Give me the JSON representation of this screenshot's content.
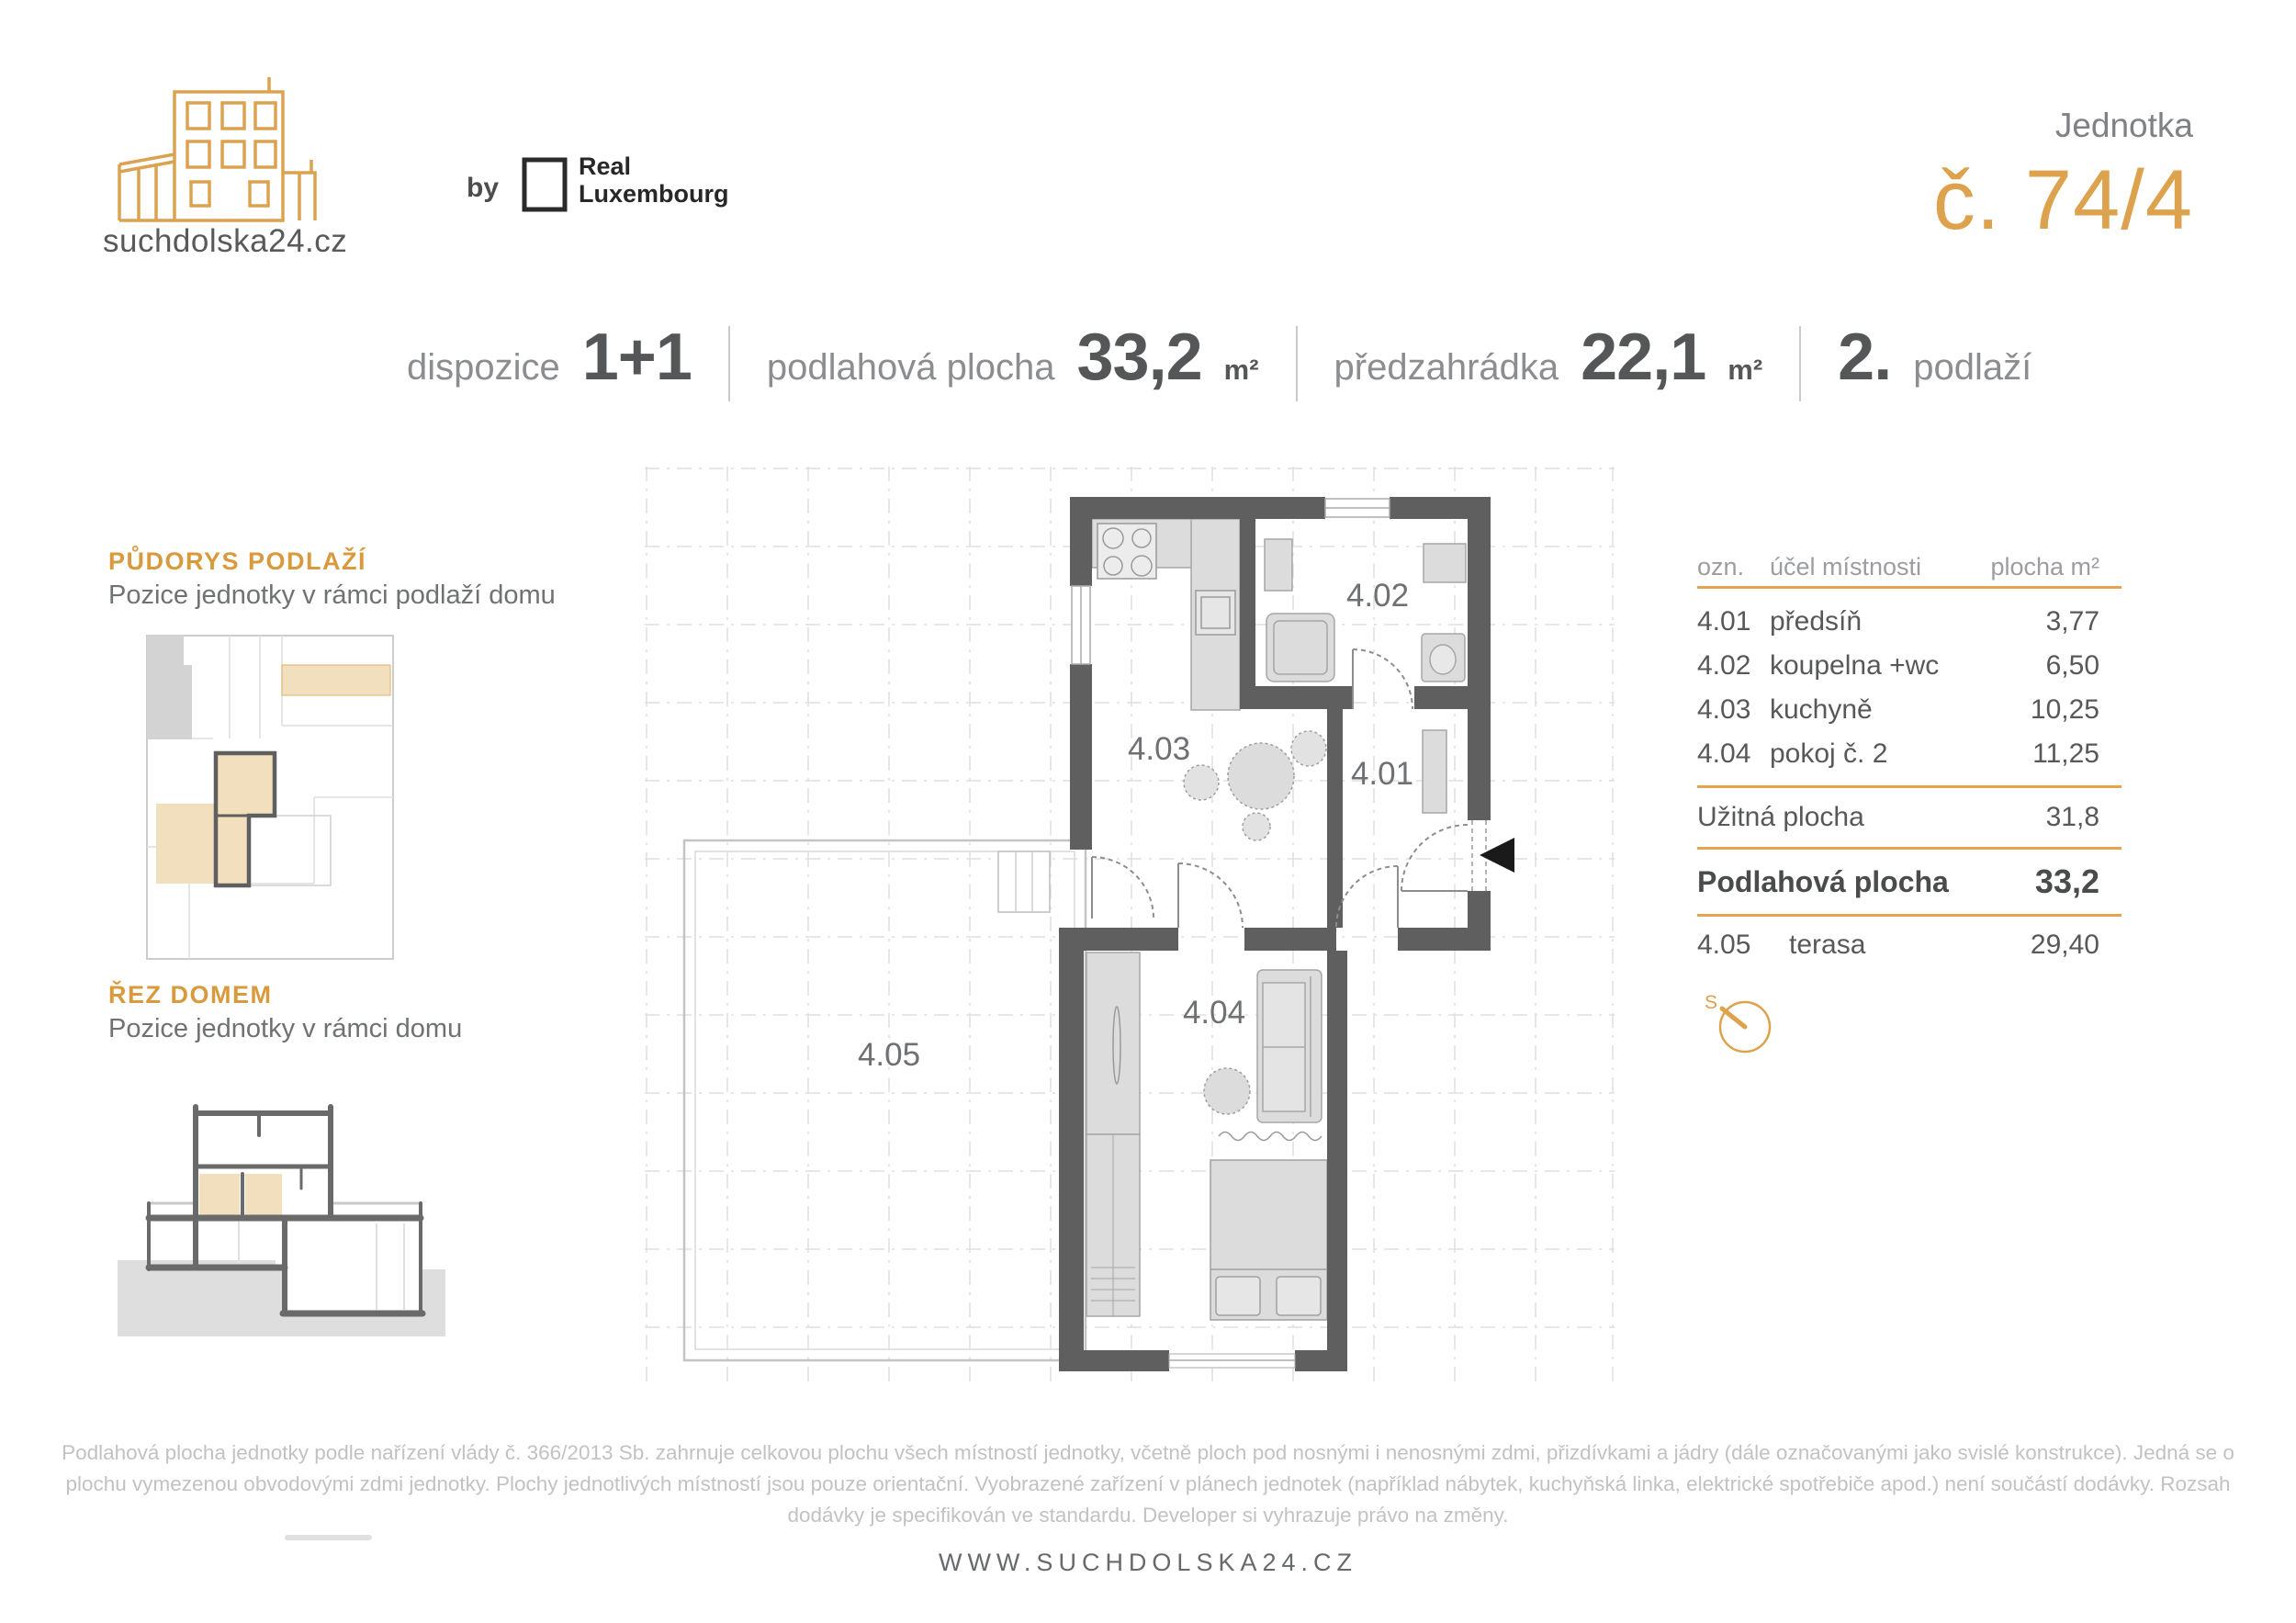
{
  "header": {
    "site_name": "suchdolska24.cz",
    "by_label": "by",
    "partner_name_line1": "Real",
    "partner_name_line2": "Luxembourg",
    "unit_label": "Jednotka",
    "unit_number": "č. 74/4"
  },
  "specs": {
    "dispozice_label": "dispozice",
    "dispozice_value": "1+1",
    "podlahova_label": "podlahová plocha",
    "podlahova_value": "33,2",
    "podlahova_unit": "m²",
    "predzahradka_label": "předzahrádka",
    "predzahradka_value": "22,1",
    "predzahradka_unit": "m²",
    "podlazi_value": "2.",
    "podlazi_label": "podlaží"
  },
  "sidebar": {
    "pudorys_title": "PŮDORYS PODLAŽÍ",
    "pudorys_subtitle": "Pozice jednotky v rámci podlaží domu",
    "rez_title": "ŘEZ DOMEM",
    "rez_subtitle": "Pozice jednotky v rámci domu"
  },
  "plan": {
    "room_401": "4.01",
    "room_402": "4.02",
    "room_403": "4.03",
    "room_404": "4.04",
    "room_405": "4.05"
  },
  "table": {
    "header_ozn": "ozn.",
    "header_ucel": "účel místnosti",
    "header_plocha": "plocha m²",
    "rows": [
      {
        "id": "4.01",
        "name": "předsíň",
        "area": "3,77"
      },
      {
        "id": "4.02",
        "name": "koupelna +wc",
        "area": "6,50"
      },
      {
        "id": "4.03",
        "name": "kuchyně",
        "area": "10,25"
      },
      {
        "id": "4.04",
        "name": "pokoj č. 2",
        "area": "11,25"
      }
    ],
    "uzitna_label": "Užitná plocha",
    "uzitna_value": "31,8",
    "podlahova_label": "Podlahová plocha",
    "podlahova_value": "33,2",
    "terasa_id": "4.05",
    "terasa_name": "terasa",
    "terasa_area": "29,40",
    "compass_label": "S"
  },
  "footer": {
    "disclaimer_line1": "Podlahová plocha jednotky podle nařízení vlády č. 366/2013 Sb. zahrnuje celkovou plochu všech místností jednotky, včetně ploch pod nosnými i nenosnými zdmi, přizdívkami a jádry (dále označovanými jako svislé konstrukce). Jedná se o",
    "disclaimer_line2": "plochu vymezenou obvodovými zdmi jednotky. Plochy jednotlivých místností jsou pouze orientační. Vyobrazené zařízení v plánech jednotek (například nábytek, kuchyňská linka, elektrické spotřebiče apod.) není součástí dodávky. Rozsah",
    "disclaimer_line3": "dodávky je specifikován ve standardu. Developer si vyhrazuje právo na změny.",
    "website": "WWW.SUCHDOLSKA24.CZ"
  },
  "colors": {
    "accent_gold": "#DDA24C",
    "wall_gray": "#5F5F60",
    "furniture_gray": "#DCDCDC",
    "highlight_tan": "#F2DFBD",
    "text_dark": "#58595B",
    "text_gray": "#8A8C8F",
    "text_light": "#C2C2C2"
  }
}
